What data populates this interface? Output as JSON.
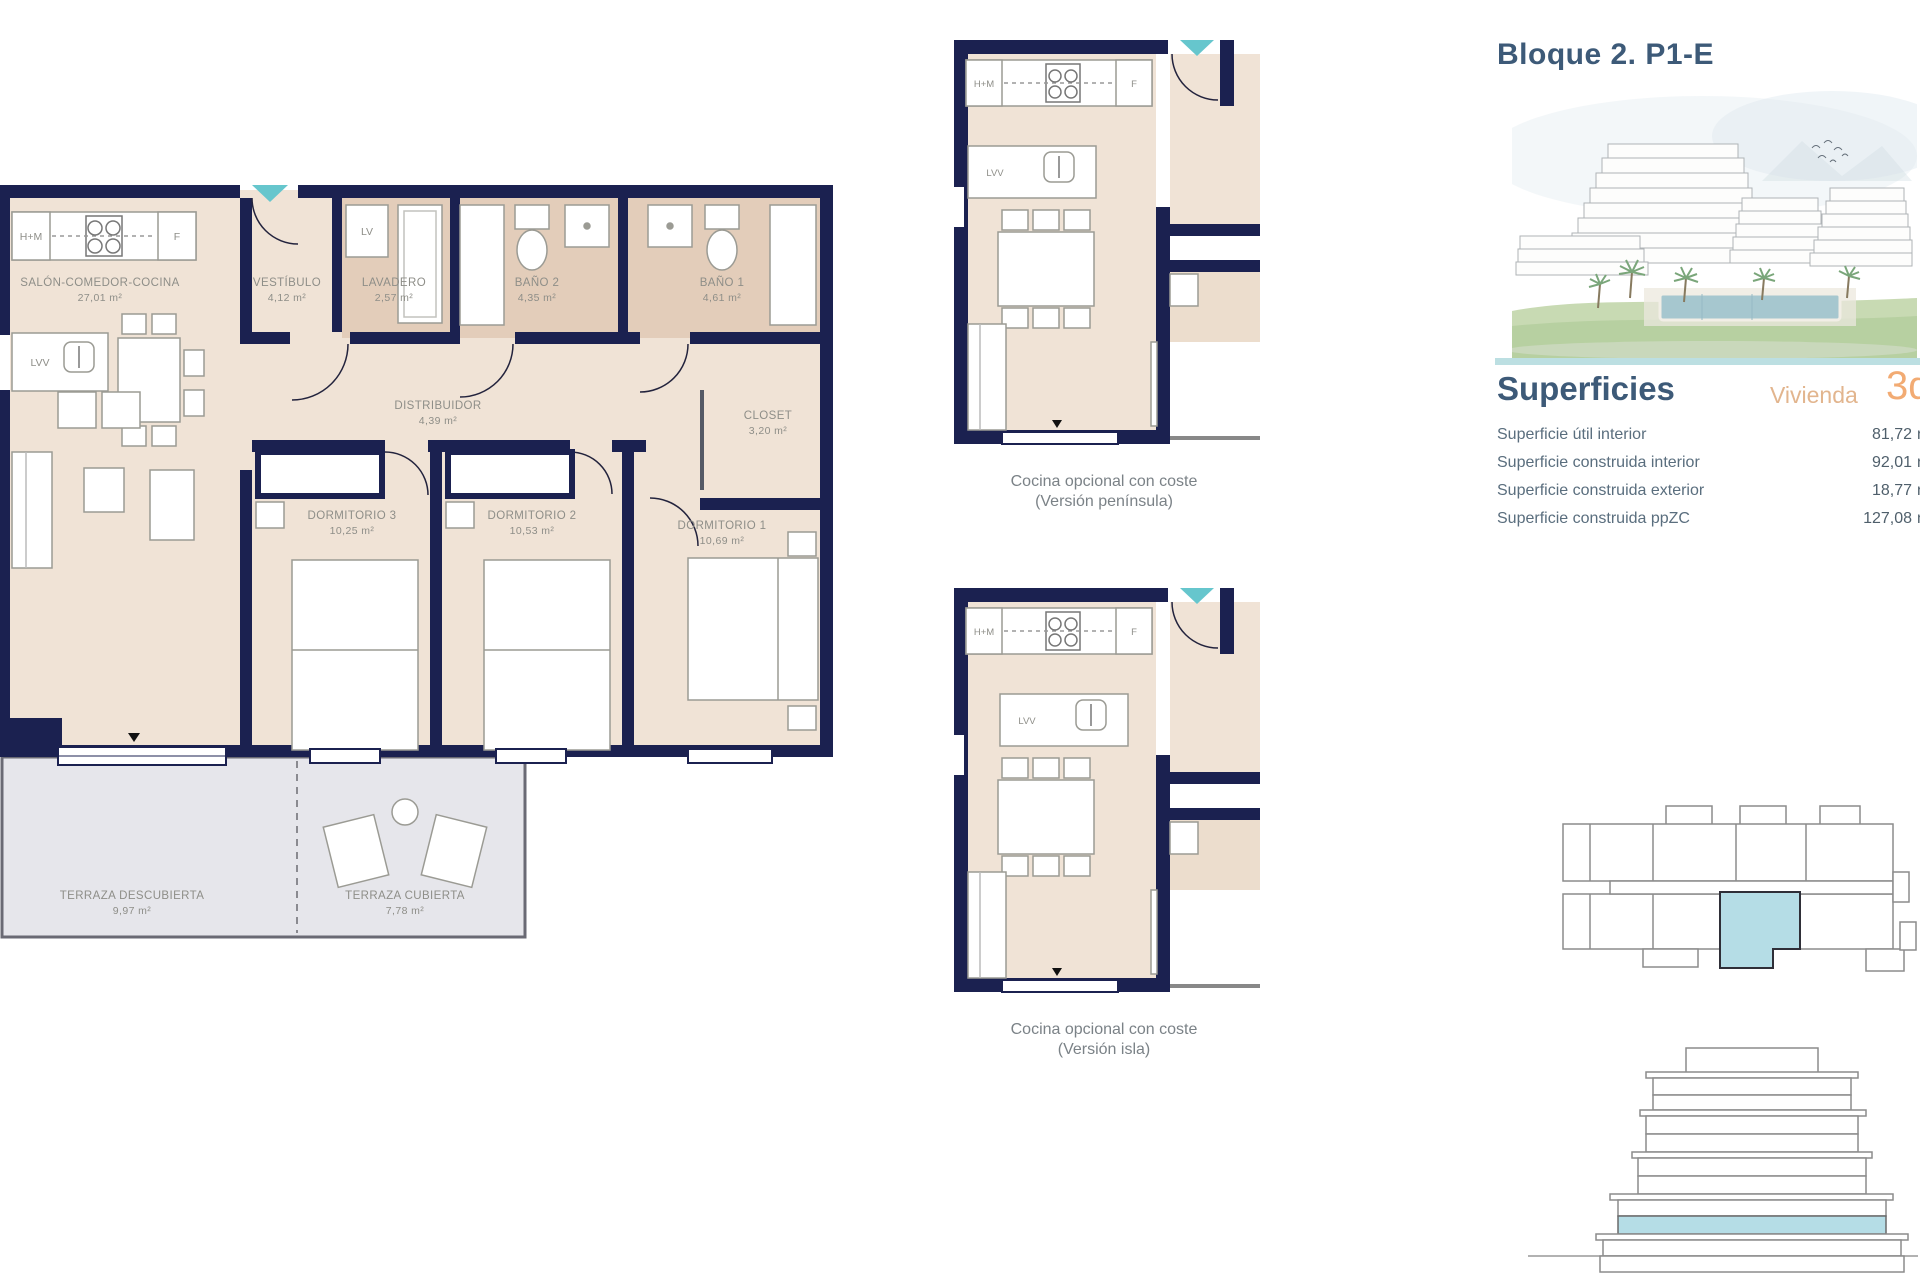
{
  "main_plan": {
    "rooms": [
      {
        "name": "SALÓN-COMEDOR-COCINA",
        "area": "27,01 m²"
      },
      {
        "name": "VESTÍBULO",
        "area": "4,12 m²"
      },
      {
        "name": "LAVADERO",
        "area": "2,57 m²"
      },
      {
        "name": "BAÑO 2",
        "area": "4,35 m²"
      },
      {
        "name": "BAÑO 1",
        "area": "4,61 m²"
      },
      {
        "name": "DISTRIBUIDOR",
        "area": "4,39 m²"
      },
      {
        "name": "CLOSET",
        "area": "3,20 m²"
      },
      {
        "name": "DORMITORIO 3",
        "area": "10,25 m²"
      },
      {
        "name": "DORMITORIO 2",
        "area": "10,53 m²"
      },
      {
        "name": "DORMITORIO 1",
        "area": "10,69 m²"
      },
      {
        "name": "TERRAZA DESCUBIERTA",
        "area": "9,97 m²"
      },
      {
        "name": "TERRAZA CUBIERTA",
        "area": "7,78 m²"
      }
    ]
  },
  "fixture_labels": {
    "hm": "H+M",
    "f": "F",
    "lv": "LV",
    "lvv": "LVV"
  },
  "kitchen_options": [
    {
      "caption_line1": "Cocina opcional con coste",
      "caption_line2": "(Versión península)"
    },
    {
      "caption_line1": "Cocina opcional con coste",
      "caption_line2": "(Versión isla)"
    }
  ],
  "info_panel": {
    "title": "Bloque 2. P1-E",
    "superficies": {
      "heading": "Superficies",
      "vivienda_label": "Vivienda",
      "vivienda_number": "3d",
      "rows": [
        {
          "label": "Superficie útil interior",
          "number": "81,72",
          "unit": "m²"
        },
        {
          "label": "Superficie construida interior",
          "number": "92,01",
          "unit": "m²"
        },
        {
          "label": "Superficie construida exterior",
          "number": "18,77",
          "unit": "m²"
        },
        {
          "label": "Superficie construida ppZC",
          "number": "127,08",
          "unit": "m²"
        }
      ]
    }
  },
  "colors": {
    "wall_navy": "#1b2150",
    "floor_beige": "#f0e3d6",
    "floor_tan": "#e3cdba",
    "terrace_gray": "#e6e6eb",
    "accent_teal": "#66c6cd",
    "highlight_blue": "#b5dde6",
    "heading_slate": "#3d5a78",
    "vivienda_tan": "#e2b58e",
    "number_orange": "#f2ab73"
  }
}
